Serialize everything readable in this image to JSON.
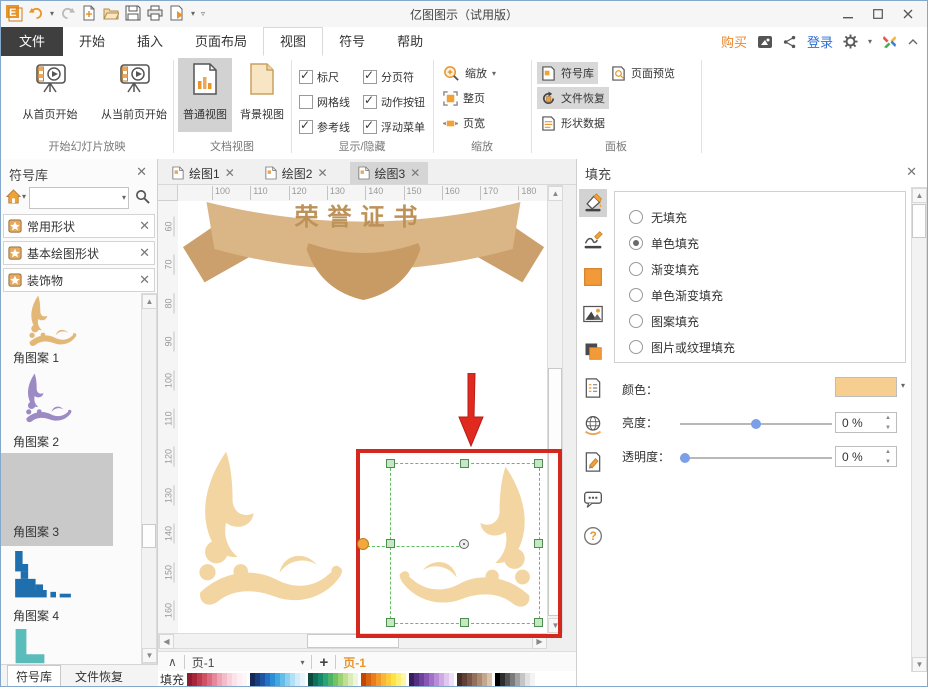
{
  "titlebar": {
    "title": "亿图图示（试用版）",
    "quick_access_icons": [
      "edraw-logo",
      "undo",
      "redo",
      "new-document",
      "open-folder",
      "save",
      "print",
      "export"
    ],
    "window_controls": {
      "minimize": "–",
      "maximize": "□",
      "close": "✕"
    }
  },
  "menu": {
    "file_tab": "文件",
    "tabs": [
      "开始",
      "插入",
      "页面布局",
      "视图",
      "符号",
      "帮助"
    ],
    "active_tab": "视图",
    "right": {
      "buy": "购买",
      "login": "登录"
    }
  },
  "ribbon": {
    "slideshow": {
      "label": "开始幻灯片放映",
      "from_first": "从首页开始",
      "from_current": "从当前页开始"
    },
    "docview": {
      "label": "文档视图",
      "normal": "普通视图",
      "background": "背景视图",
      "selected": "普通视图"
    },
    "showhide": {
      "label": "显示/隐藏",
      "checkboxes": [
        {
          "label": "标尺",
          "checked": true
        },
        {
          "label": "分页符",
          "checked": true
        },
        {
          "label": "网格线",
          "checked": false
        },
        {
          "label": "动作按钮",
          "checked": true
        },
        {
          "label": "参考线",
          "checked": true
        },
        {
          "label": "浮动菜单",
          "checked": true
        }
      ]
    },
    "zoom": {
      "label": "缩放",
      "zoom_btn": "缩放",
      "whole_page": "整页",
      "page_width": "页宽"
    },
    "panel": {
      "label": "面板",
      "symbol_lib": "符号库",
      "file_recover": "文件恢复",
      "shape_data": "形状数据",
      "page_preview": "页面预览",
      "highlighted": [
        "符号库",
        "文件恢复"
      ]
    }
  },
  "sidebar": {
    "title": "符号库",
    "search_placeholder": "",
    "sections": [
      "常用形状",
      "基本绘图形状",
      "装饰物"
    ],
    "symbols": [
      {
        "label": "角图案 1",
        "selected": false
      },
      {
        "label": "角图案 2",
        "selected": false
      },
      {
        "label": "角图案 3",
        "selected": true
      },
      {
        "label": "角图案 4",
        "selected": false
      }
    ],
    "bottom_tabs": [
      "符号库",
      "文件恢复"
    ],
    "bottom_active": "符号库"
  },
  "canvas": {
    "doc_tabs": [
      {
        "label": "绘图1",
        "active": false
      },
      {
        "label": "绘图2",
        "active": false
      },
      {
        "label": "绘图3",
        "active": true
      }
    ],
    "h_ruler": [
      100,
      110,
      120,
      130,
      140,
      150,
      160,
      170,
      180,
      190
    ],
    "v_ruler": [
      60,
      70,
      80,
      90,
      100,
      110,
      120,
      130,
      140,
      150,
      160
    ],
    "banner_text": "荣誉证书",
    "page_nav": {
      "collapse": "∧",
      "page_dropdown": "页-1",
      "add_page": "+",
      "active_page": "页-1"
    },
    "fill_strip_label": "填充",
    "palette_groups": [
      [
        "#8c1d2f",
        "#a82639",
        "#be3a4e",
        "#d05064",
        "#dd6b80",
        "#e7879b",
        "#efa3b4",
        "#f4bcc9",
        "#f8d2db",
        "#fbe3e9",
        "#fdeff2",
        "#fef7f9"
      ],
      [
        "#15285a",
        "#1a3c7c",
        "#1f55a5",
        "#2470c4",
        "#2c8ed5",
        "#3fa9df",
        "#62bee8",
        "#8bd0ef",
        "#b2e0f5",
        "#d2ecfa",
        "#e8f6fc"
      ],
      [
        "#0b4b40",
        "#107059",
        "#17896b",
        "#2ba375",
        "#4bb468",
        "#74c363",
        "#9dd272",
        "#bfe093",
        "#daedb8",
        "#edf6db"
      ],
      [
        "#c04800",
        "#d86310",
        "#ea7e1c",
        "#f49a2b",
        "#fab637",
        "#fcce3c",
        "#ffe342",
        "#ffef70",
        "#fff6a8"
      ],
      [
        "#381e60",
        "#533080",
        "#6d429d",
        "#8857b5",
        "#a170c7",
        "#b88dd6",
        "#cdaae3",
        "#dfc7ed",
        "#eee0f6"
      ],
      [
        "#452c24",
        "#5f4036",
        "#795648",
        "#93705c",
        "#ac8a72",
        "#c4a68c",
        "#dac3a9"
      ],
      [
        "#000000",
        "#2d2d2d",
        "#545454",
        "#7b7b7b",
        "#a2a2a2",
        "#c5c5c5",
        "#e2e2e2",
        "#f3f3f3"
      ]
    ]
  },
  "fill_panel": {
    "title": "填充",
    "tools": [
      {
        "icon": "fill-bucket-icon",
        "selected": true
      },
      {
        "icon": "line-style-icon",
        "selected": false
      },
      {
        "icon": "color-square-icon",
        "selected": false
      },
      {
        "icon": "picture-icon",
        "selected": false
      },
      {
        "icon": "layers-icon",
        "selected": false
      },
      {
        "icon": "shape-notes-icon",
        "selected": false
      },
      {
        "icon": "hyperlink-globe-icon",
        "selected": false
      },
      {
        "icon": "attachment-icon",
        "selected": false
      },
      {
        "icon": "comment-icon",
        "selected": false
      },
      {
        "icon": "help-icon",
        "selected": false
      }
    ],
    "options": [
      {
        "label": "无填充",
        "selected": false
      },
      {
        "label": "单色填充",
        "selected": true
      },
      {
        "label": "渐变填充",
        "selected": false
      },
      {
        "label": "单色渐变填充",
        "selected": false
      },
      {
        "label": "图案填充",
        "selected": false
      },
      {
        "label": "图片或纹理填充",
        "selected": false
      }
    ],
    "color_label": "颜色：",
    "swatch_color": "#f6ce8f",
    "brightness": {
      "label": "亮度：",
      "value": "0 %",
      "pos": 0.5
    },
    "transparency": {
      "label": "透明度：",
      "value": "0 %",
      "pos": 0.03
    }
  },
  "colors": {
    "accent_orange": "#e8962c",
    "banner_tan": "#dab585",
    "ornament_tan": "#f3d5a1",
    "annotation_red": "#d4281e",
    "selection_green": "#5fbf5f",
    "login_blue": "#2f6fd4"
  }
}
